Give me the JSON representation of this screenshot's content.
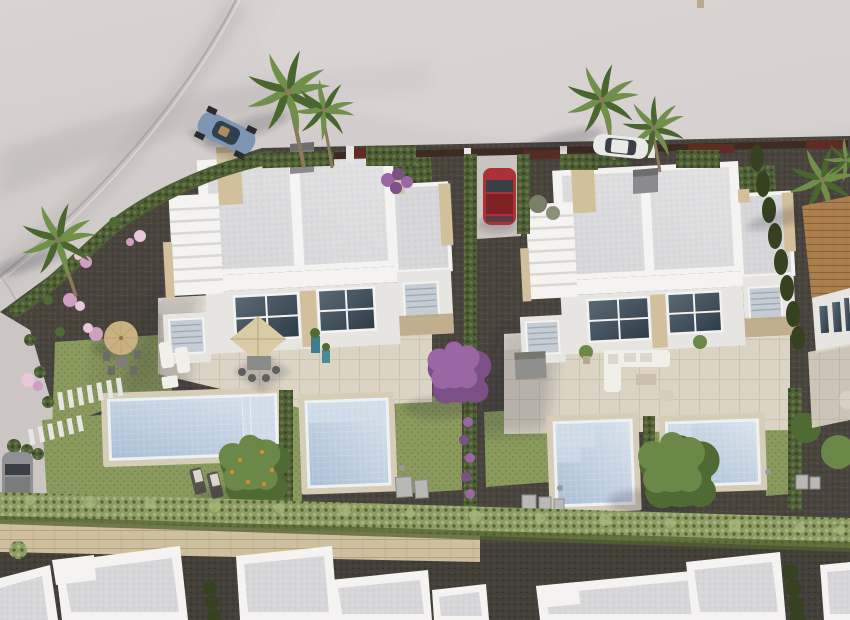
{
  "meta": {
    "title": "Aerial 3D architectural render",
    "width_px": 850,
    "height_px": 620
  },
  "scene": {
    "type": "3d-architectural-aerial-render",
    "description": "Aerial 3D render of a residential development: two white semi-detached villas with flat gravel roofs, rooftop stair towers and terraces, four private pools with lawns, dark gravel gardens with pink and purple flowering shrubs, palm trees, perimeter cypress hedges, parked cars (blue convertible, white car, red car, gray car), a stone boundary wall with a long hedge row, a row of white flat roofs along the bottom, and a tiled-roof neighbor house on the right edge.",
    "counts": {
      "villas": 2,
      "pools": 4,
      "cars": 4,
      "palm_trees": 6,
      "bottom_roofs": 7
    }
  },
  "colors": {
    "land1": "#d6d1d0",
    "land2": "#cbc5c4",
    "land3": "#b5aeae",
    "curb": "#aaa3a2",
    "gravel": "#49443d",
    "gravelDot": "#5b554c",
    "gravelDark": "#38342d",
    "lawn": "#8a9a5e",
    "lawnDot": "#768a4c",
    "lawnShade": "#69793f",
    "hedge": "#4e5f35",
    "hedgeDot": "#65774a",
    "hedgeDark": "#36421f",
    "olive": "#8d9c64",
    "oliveDot": "#a7b67a",
    "oliveShade": "#51602f",
    "pave": "#dbd4c5",
    "paveLine": "#ccc4b2",
    "paveHi": "#ebe6da",
    "deck": "#d6cdb9",
    "water1": "#aabfd4",
    "water2": "#d8e2ec",
    "poolStep": "#cfdbe8",
    "poolRim": "#eef1f3",
    "roof": "#d7d7d9",
    "roofDot": "#c7c7cb",
    "roofShade": "#c2c3c7",
    "white": "#f4f3f1",
    "whiteShade": "#d9d7d4",
    "whiteDim": "#e7e5e2",
    "tan": "#d2bf9b",
    "tanShade": "#b9a57f",
    "stoneWall": "#cec09f",
    "stoneLine": "#b1a281",
    "path": "#434039",
    "pathDot": "#585349",
    "glass1": "#5a6a75",
    "glass2": "#2e3c48",
    "blind": "#c5ccd3",
    "blindLine": "#9daab4",
    "fence": "#3d2b21",
    "maroon": "#5e2c22",
    "chimney": "#8b8b8d",
    "chimney2": "#6e6e70",
    "palm1": "#6f8f4a",
    "palm2": "#49662f",
    "trunk": "#8a795c",
    "tree1": "#6c8848",
    "tree2": "#4f6a33",
    "orange": "#d98f2b",
    "purple": "#9a66a4",
    "purple2": "#7c4f86",
    "pink": "#cf9ec0",
    "pink2": "#e6c6d8",
    "carBlue": "#7e95b3",
    "carBlueDark": "#31404e",
    "carRed": "#ac3136",
    "carRedDark": "#7e2226",
    "carWhite": "#e9e9e7",
    "carGray": "#8f9092",
    "glassCar": "#3a3f46",
    "umbrella": "#c9b182",
    "parasol": "#d8cba6",
    "sofa": "#f1efe9",
    "tile": "#ac7f4e",
    "tileLine": "#8a6238",
    "box": "#b9b8b5",
    "shadow": "rgba(45,40,50,0.20)"
  }
}
